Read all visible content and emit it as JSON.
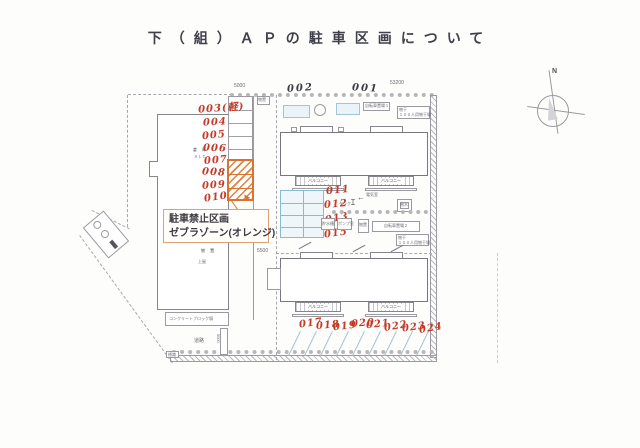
{
  "title": "下（組）ＡＰの駐車区画について",
  "legend": {
    "no_parking_line1": "駐車禁止区画",
    "no_parking_line2": "ゼブラゾーン(オレンジ)"
  },
  "numbers": {
    "left": [
      "003(軽)",
      "004",
      "005",
      "006",
      "007",
      "008",
      "009",
      "010"
    ],
    "top": [
      "002",
      "001"
    ],
    "mid": [
      "011",
      "012",
      "013",
      "015"
    ],
    "bottom": [
      "017",
      "018",
      "019",
      "020",
      "021",
      "022",
      "023",
      "024"
    ]
  },
  "dimensions": {
    "top_left": "5000",
    "top_right": "53200",
    "mid": "5500",
    "road_side": "5000"
  },
  "compass": {
    "north": "N"
  },
  "labels": {
    "balcony": "バルコニー",
    "road": "道路",
    "sign": "標識",
    "storage1": "倉 庫",
    "alc": "ＡＬＣ",
    "storage2": "物 置",
    "canopy": "上屋",
    "block_wall": "コンクリートブロック塀",
    "shed_top": "物置",
    "bicycle1": "自転車置場１",
    "bicycle2": "自転車置場２",
    "drying": "物干",
    "drying_sub": "１００人用物干場",
    "tank": "タンク",
    "water_tank": "貯水槽",
    "pump": "ポンプ室",
    "electric": "電気室",
    "tree": "樹木"
  }
}
